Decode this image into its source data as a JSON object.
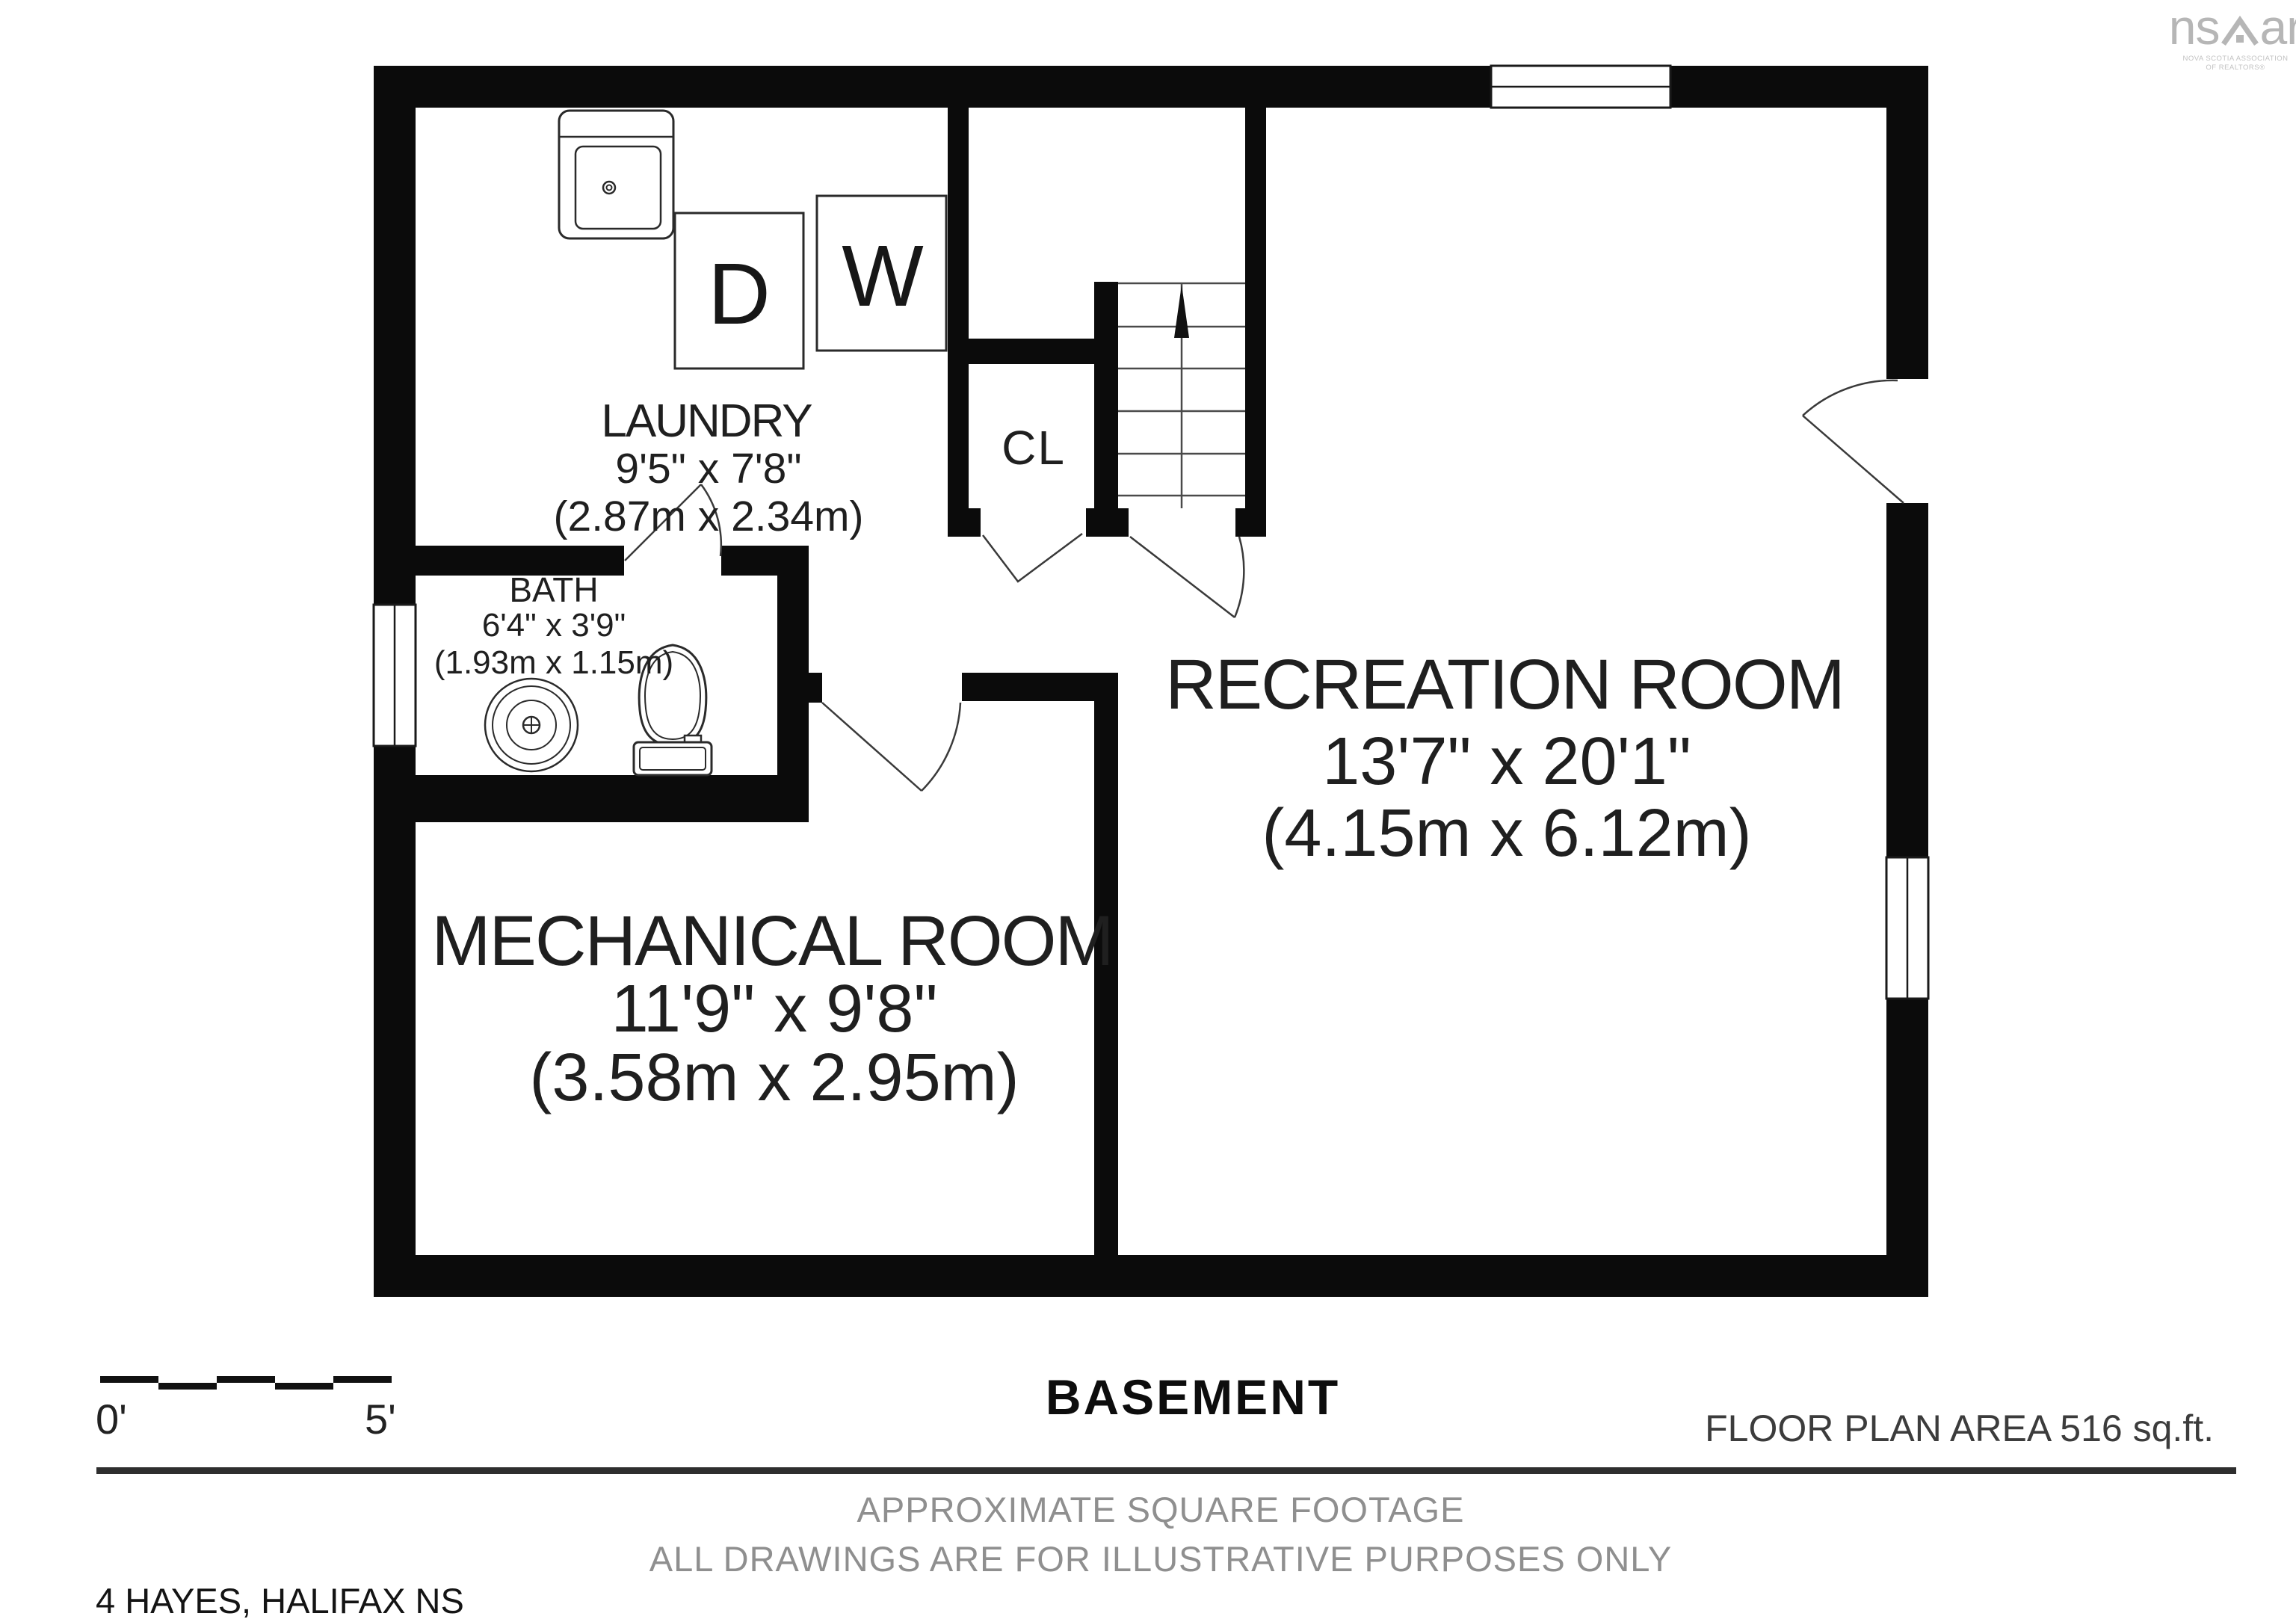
{
  "meta": {
    "floor_title": "BASEMENT",
    "floor_area_label": "FLOOR PLAN AREA 516 sq.ft.",
    "address": "4 HAYES, HALIFAX NS"
  },
  "disclaimer": {
    "line1": "APPROXIMATE SQUARE FOOTAGE",
    "line2": "ALL DRAWINGS ARE FOR ILLUSTRATIVE PURPOSES ONLY"
  },
  "scale_bar": {
    "start_label": "0'",
    "end_label": "5'"
  },
  "logo": {
    "brand_left": "ns",
    "brand_right": "ar",
    "sub_line1": "NOVA SCOTIA ASSOCIATION",
    "sub_line2": "OF REALTORS®"
  },
  "rooms": {
    "laundry": {
      "name": "LAUNDRY",
      "dims_imperial": "9'5\" x 7'8\"",
      "dims_metric": "(2.87m x 2.34m)"
    },
    "bath": {
      "name": "BATH",
      "dims_imperial": "6'4\" x 3'9\"",
      "dims_metric": "(1.93m x 1.15m)"
    },
    "closet": {
      "name": "CL"
    },
    "recreation": {
      "name": "RECREATION ROOM",
      "dims_imperial": "13'7\" x 20'1\"",
      "dims_metric": "(4.15m x 6.12m)"
    },
    "mechanical": {
      "name": "MECHANICAL ROOM",
      "dims_imperial": "11'9\" x 9'8\"",
      "dims_metric": "(3.58m x 2.95m)"
    }
  },
  "appliances": {
    "dryer": "D",
    "washer": "W"
  },
  "stairs": {
    "direction": "up"
  },
  "colors": {
    "wall": "#0b0b0b",
    "fixture_line": "#2a2a2a",
    "door_line": "#3a3a3a",
    "muted_text": "#8f8f8f",
    "area_text": "#3c3c3c",
    "logo_gray": "#b6b6b6"
  }
}
